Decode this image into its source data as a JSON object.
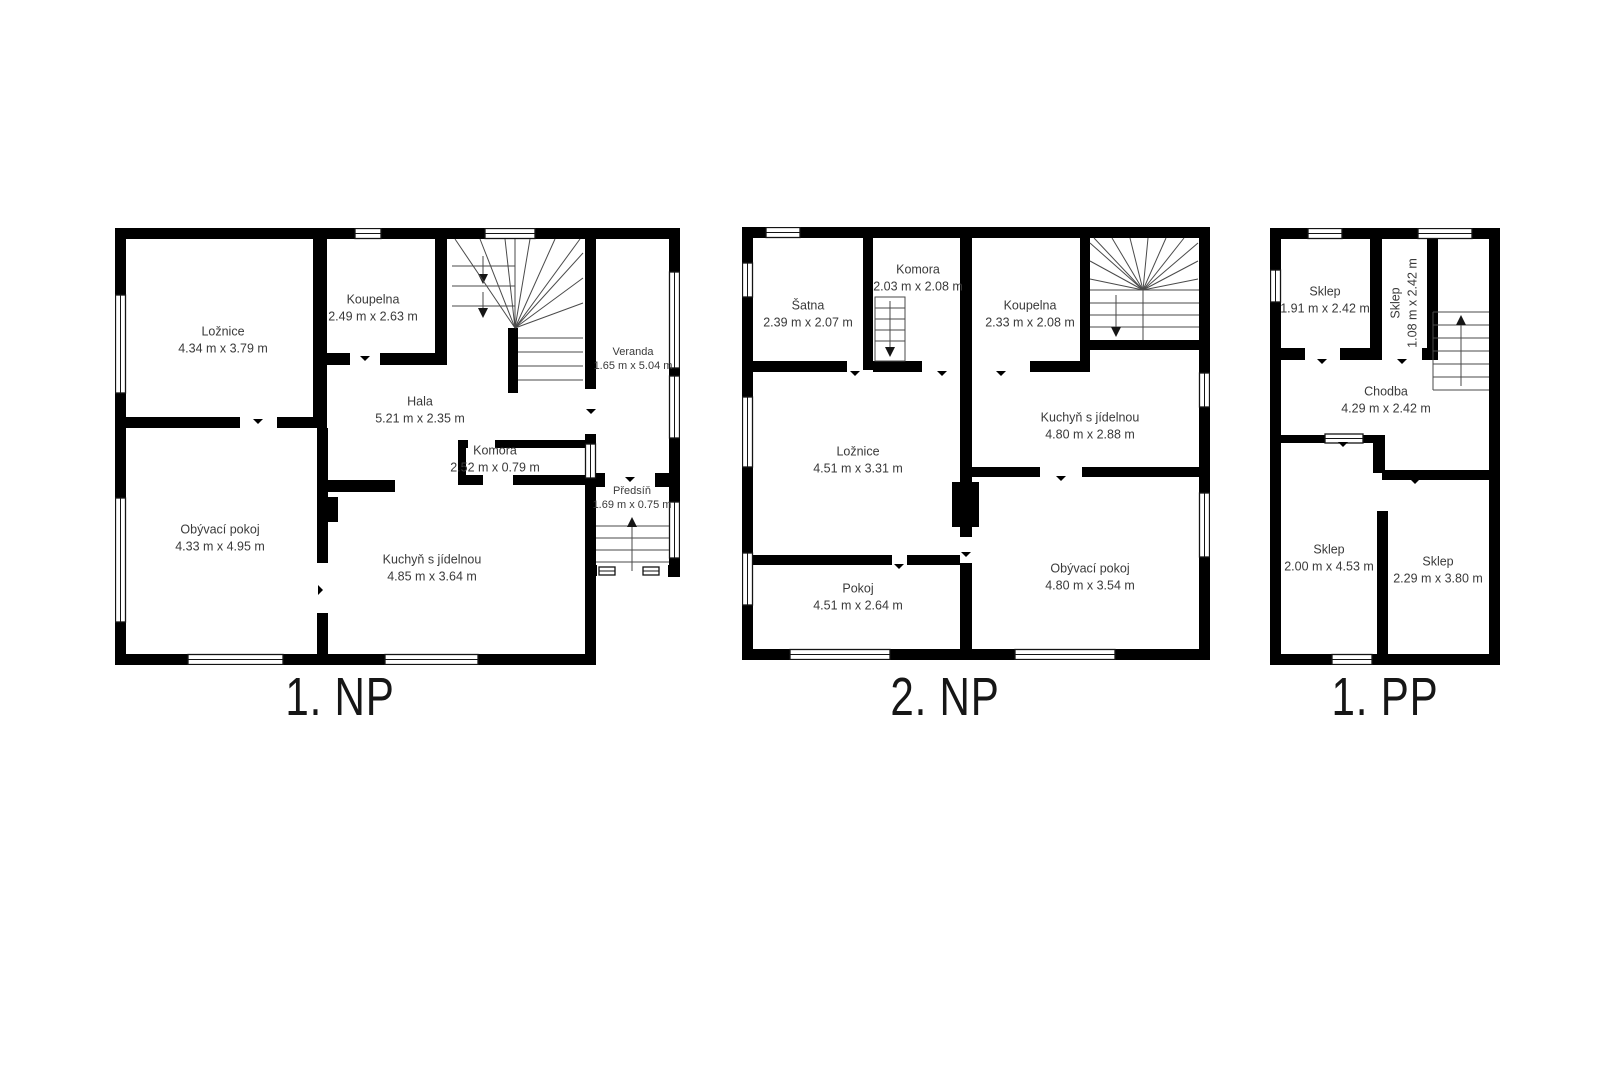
{
  "page": {
    "background": "#ffffff",
    "wall_color": "#000000",
    "text_color": "#3a3a3a"
  },
  "floors": [
    {
      "id": "np1",
      "title": "1. NP",
      "rooms": [
        {
          "name": "Ložnice",
          "size": "4.34 m x 3.79 m"
        },
        {
          "name": "Koupelna",
          "size": "2.49 m x 2.63 m"
        },
        {
          "name": "Hala",
          "size": "5.21 m x 2.35 m"
        },
        {
          "name": "Veranda",
          "size": "1.65 m x 5.04 m"
        },
        {
          "name": "Komora",
          "size": "2.52 m x 0.79 m"
        },
        {
          "name": "Obývací pokoj",
          "size": "4.33 m x 4.95 m"
        },
        {
          "name": "Kuchyň s jídelnou",
          "size": "4.85 m x 3.64 m"
        },
        {
          "name": "Předsíň",
          "size": "1.69 m x 0.75 m"
        }
      ]
    },
    {
      "id": "np2",
      "title": "2. NP",
      "rooms": [
        {
          "name": "Šatna",
          "size": "2.39 m x 2.07 m"
        },
        {
          "name": "Komora",
          "size": "2.03 m x 2.08 m"
        },
        {
          "name": "Koupelna",
          "size": "2.33 m x 2.08 m"
        },
        {
          "name": "Ložnice",
          "size": "4.51 m x 3.31 m"
        },
        {
          "name": "Kuchyň s jídelnou",
          "size": "4.80 m x 2.88 m"
        },
        {
          "name": "Pokoj",
          "size": "4.51 m x 2.64 m"
        },
        {
          "name": "Obývací pokoj",
          "size": "4.80 m x 3.54 m"
        }
      ]
    },
    {
      "id": "pp1",
      "title": "1. PP",
      "rooms": [
        {
          "name": "Sklep",
          "size": "1.91 m x 2.42 m"
        },
        {
          "name": "Sklep",
          "size": "1.08 m x 2.42 m"
        },
        {
          "name": "Chodba",
          "size": "4.29 m x 2.42 m"
        },
        {
          "name": "Sklep",
          "size": "2.00 m x 4.53 m"
        },
        {
          "name": "Sklep",
          "size": "2.29 m x 3.80 m"
        }
      ]
    }
  ]
}
